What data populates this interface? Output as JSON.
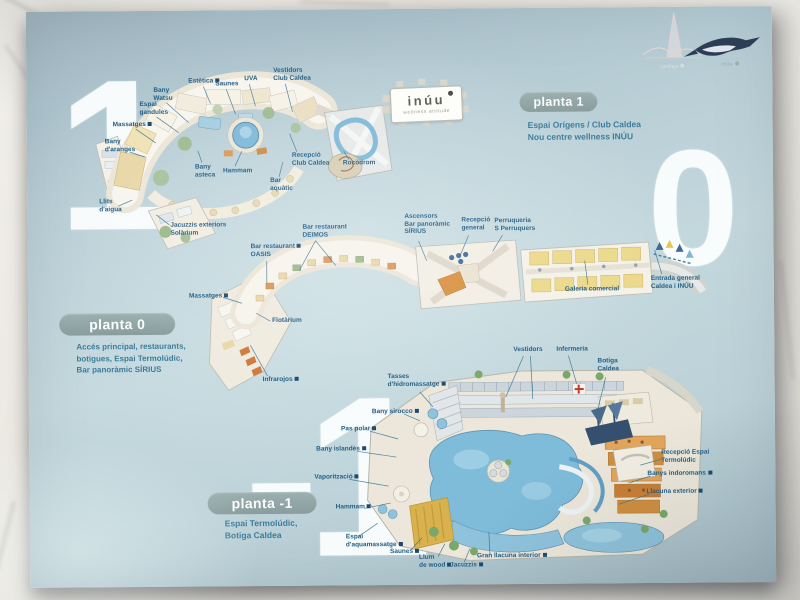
{
  "brand": {
    "caldea_mark": "caldea",
    "inuu_mark": "inúu",
    "inuu_sign_name": "inúu",
    "inuu_sign_tagline": "wellness attitude"
  },
  "floors": [
    {
      "numeral": "1",
      "pill_label": "planta 1",
      "subtitle_lines": [
        "Espai Orígens / Club Caldea",
        "Nou centre wellness INÚU"
      ],
      "labels": [
        {
          "lines": [
            "Estètica"
          ],
          "iconLine": 0,
          "x": 190,
          "y": 76,
          "leaders": [
            [
              205,
              85,
              212,
              102
            ]
          ]
        },
        {
          "lines": [
            "Saunes"
          ],
          "x": 217,
          "y": 79,
          "leaders": [
            [
              228,
              88,
              237,
              113
            ]
          ]
        },
        {
          "lines": [
            "UVA"
          ],
          "x": 246,
          "y": 74,
          "leaders": [
            [
              251,
              83,
              257,
              105
            ]
          ]
        },
        {
          "lines": [
            "Vestidors",
            "Club Caldea"
          ],
          "x": 275,
          "y": 66,
          "leaders": [
            [
              287,
              83,
              294,
              111
            ]
          ]
        },
        {
          "lines": [
            "Bany",
            "Watsu"
          ],
          "x": 155,
          "y": 85,
          "leaders": [
            [
              168,
              101,
              190,
              121
            ]
          ]
        },
        {
          "lines": [
            "Espai",
            "gandules"
          ],
          "x": 141,
          "y": 99,
          "leaders": [
            [
              158,
              115,
              180,
              131
            ]
          ]
        },
        {
          "lines": [
            "Massatges"
          ],
          "iconLine": 0,
          "x": 114,
          "y": 119,
          "leaders": [
            [
              137,
              127,
              157,
              141
            ]
          ]
        },
        {
          "lines": [
            "Bany",
            "d'aranges"
          ],
          "x": 106,
          "y": 136,
          "leaders": [
            [
              131,
              150,
              146,
              155
            ]
          ]
        },
        {
          "lines": [
            "Llits",
            "d'aigua"
          ],
          "x": 100,
          "y": 196,
          "leaders": [
            [
              119,
              204,
              133,
              198
            ]
          ]
        },
        {
          "lines": [
            "Jacuzzis exteriors",
            "Solàrium"
          ],
          "x": 171,
          "y": 220,
          "leaders": [
            [
              170,
              223,
              157,
              213
            ]
          ]
        },
        {
          "lines": [
            "Bany",
            "asteca"
          ],
          "x": 196,
          "y": 162,
          "leaders": [
            [
              203,
              161,
              199,
              149
            ]
          ]
        },
        {
          "lines": [
            "Hammam"
          ],
          "x": 224,
          "y": 166,
          "leaders": [
            [
              236,
              165,
              243,
              150
            ]
          ]
        },
        {
          "lines": [
            "Bar",
            "aquàtic"
          ],
          "x": 271,
          "y": 176,
          "leaders": [
            [
              280,
              176,
              284,
              161
            ]
          ]
        },
        {
          "lines": [
            "Recepció",
            "Club Caldea"
          ],
          "x": 293,
          "y": 151,
          "leaders": [
            [
              298,
              151,
              291,
              133
            ]
          ]
        },
        {
          "lines": [
            "Rocòdrom"
          ],
          "x": 344,
          "y": 159,
          "leaders": [
            [
              350,
              159,
              345,
              151
            ]
          ]
        }
      ]
    },
    {
      "numeral": "0",
      "pill_label": "planta 0",
      "subtitle_lines": [
        "Accés principal, restaurants,",
        "botigues, Espai Termolúdic,",
        "Bar panoràmic SÍRIUS"
      ],
      "labels": [
        {
          "lines": [
            "Bar restaurant",
            "DEIMOS"
          ],
          "x": 303,
          "y": 223,
          "leaders": [
            [
              316,
              240,
              300,
              269
            ],
            [
              316,
              240,
              336,
              265
            ]
          ]
        },
        {
          "lines": [
            "Bar restaurant",
            "OASIS"
          ],
          "iconLine": 0,
          "x": 251,
          "y": 242,
          "leaders": [
            [
              267,
              260,
              267,
              282
            ]
          ]
        },
        {
          "lines": [
            "Flotàrium"
          ],
          "x": 272,
          "y": 316,
          "leaders": [
            [
              270,
              320,
              256,
              312
            ]
          ]
        },
        {
          "lines": [
            "Massatges"
          ],
          "iconLine": 0,
          "x": 189,
          "y": 291,
          "leaders": [
            [
              223,
              296,
              242,
              302
            ]
          ]
        },
        {
          "lines": [
            "Infrarojos"
          ],
          "iconLine": 0,
          "x": 262,
          "y": 375,
          "leaders": [
            [
              267,
              375,
              250,
              344
            ]
          ]
        },
        {
          "lines": [
            "Ascensors",
            "Bar panoràmic",
            "SÍRIUS"
          ],
          "x": 405,
          "y": 213,
          "leaders": [
            [
              419,
              241,
              427,
              261
            ]
          ]
        },
        {
          "lines": [
            "Recepció",
            "general"
          ],
          "x": 462,
          "y": 217,
          "leaders": [
            [
              469,
              236,
              461,
              255
            ]
          ]
        },
        {
          "lines": [
            "Perruqueria",
            "S Perruquers"
          ],
          "x": 495,
          "y": 218,
          "leaders": [
            [
              503,
              236,
              493,
              252
            ]
          ]
        },
        {
          "lines": [
            "Galeria comercial"
          ],
          "x": 565,
          "y": 287,
          "leaders": [
            [
              588,
              286,
              585,
              262
            ]
          ]
        },
        {
          "lines": [
            "Entrada general",
            "Caldea i INÚU"
          ],
          "x": 651,
          "y": 277,
          "leaders": [
            [
              662,
              276,
              655,
              252
            ]
          ]
        }
      ]
    },
    {
      "numeral": "-1",
      "pill_label": "planta -1",
      "subtitle_lines": [
        "Espai Termolúdic,",
        "Botiga Caldea"
      ],
      "labels": [
        {
          "lines": [
            "Vestidors"
          ],
          "x": 513,
          "y": 347,
          "leaders": [
            [
              523,
              357,
              505,
              398
            ],
            [
              530,
              357,
              532,
              400
            ]
          ]
        },
        {
          "lines": [
            "Infermeria"
          ],
          "x": 556,
          "y": 347,
          "leaders": [
            [
              568,
              357,
              576,
              385
            ]
          ]
        },
        {
          "lines": [
            "Botiga",
            "Caldea"
          ],
          "x": 597,
          "y": 359,
          "leaders": [
            [
              605,
              379,
              596,
              415
            ]
          ]
        },
        {
          "lines": [
            "Tasses",
            "d'hidromassatge"
          ],
          "iconLine": 1,
          "x": 387,
          "y": 373,
          "leaders": [
            [
              419,
              392,
              432,
              407
            ]
          ]
        },
        {
          "lines": [
            "Bany sirocco"
          ],
          "iconLine": 0,
          "x": 371,
          "y": 408,
          "leaders": [
            [
              403,
              414,
              419,
              421
            ]
          ]
        },
        {
          "lines": [
            "Pas polar"
          ],
          "iconLine": 0,
          "x": 340,
          "y": 425,
          "leaders": [
            [
              369,
              431,
              397,
              439
            ]
          ]
        },
        {
          "lines": [
            "Bany islandès"
          ],
          "iconLine": 0,
          "x": 315,
          "y": 445,
          "leaders": [
            [
              356,
              451,
              395,
              457
            ]
          ]
        },
        {
          "lines": [
            "Vaporització"
          ],
          "iconLine": 0,
          "x": 313,
          "y": 473,
          "leaders": [
            [
              348,
              479,
              387,
              486
            ]
          ]
        },
        {
          "lines": [
            "Hammam"
          ],
          "iconLine": 0,
          "x": 334,
          "y": 503,
          "leaders": [
            [
              363,
              508,
              389,
              503
            ]
          ]
        },
        {
          "lines": [
            "Espai",
            "d'aquamassatge"
          ],
          "iconLine": 1,
          "x": 344,
          "y": 533,
          "leaders": [
            [
              357,
              536,
              376,
              523
            ]
          ]
        },
        {
          "lines": [
            "Saunes"
          ],
          "iconLine": 0,
          "x": 388,
          "y": 548,
          "leaders": [
            [
              409,
              550,
              420,
              538
            ]
          ]
        },
        {
          "lines": [
            "Llum",
            "de wood"
          ],
          "iconLine": 1,
          "x": 417,
          "y": 554,
          "leaders": [
            [
              436,
              557,
              443,
              544
            ]
          ]
        },
        {
          "lines": [
            "Jacuzzis"
          ],
          "iconLine": 0,
          "x": 448,
          "y": 562,
          "leaders": [
            [
              462,
              563,
              468,
              549
            ]
          ]
        },
        {
          "lines": [
            "Gran llacuna interior"
          ],
          "iconLine": 0,
          "x": 475,
          "y": 553,
          "leaders": [
            [
              488,
              555,
              487,
              533
            ]
          ]
        },
        {
          "lines": [
            "Recepció Espai",
            "Termolúdic"
          ],
          "x": 660,
          "y": 451,
          "leaders": [
            [
              661,
              461,
              639,
              467
            ]
          ]
        },
        {
          "lines": [
            "Banys indoromans"
          ],
          "iconLine": 0,
          "x": 646,
          "y": 472,
          "leaders": [
            [
              649,
              478,
              627,
              485
            ]
          ]
        },
        {
          "lines": [
            "Llacuna exterior"
          ],
          "iconLine": 0,
          "x": 645,
          "y": 490,
          "leaders": [
            [
              648,
              496,
              617,
              506
            ]
          ]
        }
      ]
    }
  ]
}
